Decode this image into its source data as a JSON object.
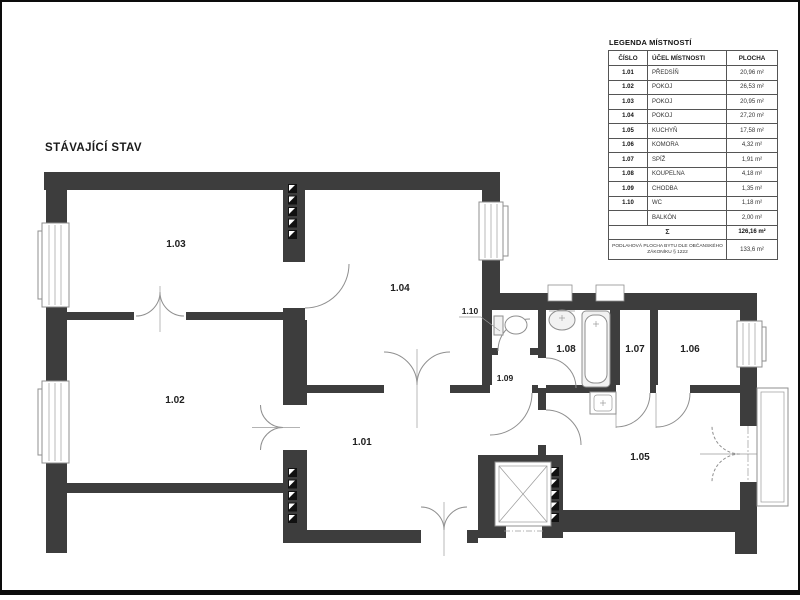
{
  "page": {
    "title": "STÁVAJÍCÍ STAV"
  },
  "legend": {
    "title": "LEGENDA MÍSTNOSTÍ",
    "columns": [
      "ČÍSLO",
      "ÚČEL MÍSTNOSTI",
      "PLOCHA"
    ],
    "rows": [
      {
        "cislo": "1.01",
        "ucel": "PŘEDSÍŇ",
        "plocha": "20,96 m²"
      },
      {
        "cislo": "1.02",
        "ucel": "POKOJ",
        "plocha": "26,53 m²"
      },
      {
        "cislo": "1.03",
        "ucel": "POKOJ",
        "plocha": "20,95 m²"
      },
      {
        "cislo": "1.04",
        "ucel": "POKOJ",
        "plocha": "27,20 m²"
      },
      {
        "cislo": "1.05",
        "ucel": "KUCHYŇ",
        "plocha": "17,58 m²"
      },
      {
        "cislo": "1.06",
        "ucel": "KOMORA",
        "plocha": "4,32 m²"
      },
      {
        "cislo": "1.07",
        "ucel": "SPÍŽ",
        "plocha": "1,91 m²"
      },
      {
        "cislo": "1.08",
        "ucel": "KOUPELNA",
        "plocha": "4,18 m²"
      },
      {
        "cislo": "1.09",
        "ucel": "CHODBA",
        "plocha": "1,35 m²"
      },
      {
        "cislo": "1.10",
        "ucel": "WC",
        "plocha": "1,18 m²"
      },
      {
        "cislo": "",
        "ucel": "BALKÓN",
        "plocha": "2,00 m²"
      }
    ],
    "sum_label": "Σ",
    "sum_value": "126,16 m²",
    "footer_label": "PODLAHOVÁ PLOCHA BYTU DLE OBČANSKÉHO ZÁKONÍKU § 1222",
    "footer_value": "133,6 m²"
  },
  "plan": {
    "labels": {
      "r101": "1.01",
      "r102": "1.02",
      "r103": "1.03",
      "r104": "1.04",
      "r105": "1.05",
      "r106": "1.06",
      "r107": "1.07",
      "r108": "1.08",
      "r109": "1.09",
      "r110": "1.10"
    }
  },
  "colors": {
    "wall": "#3d3d3d",
    "line": "#8f8f8f",
    "background": "#ffffff"
  }
}
